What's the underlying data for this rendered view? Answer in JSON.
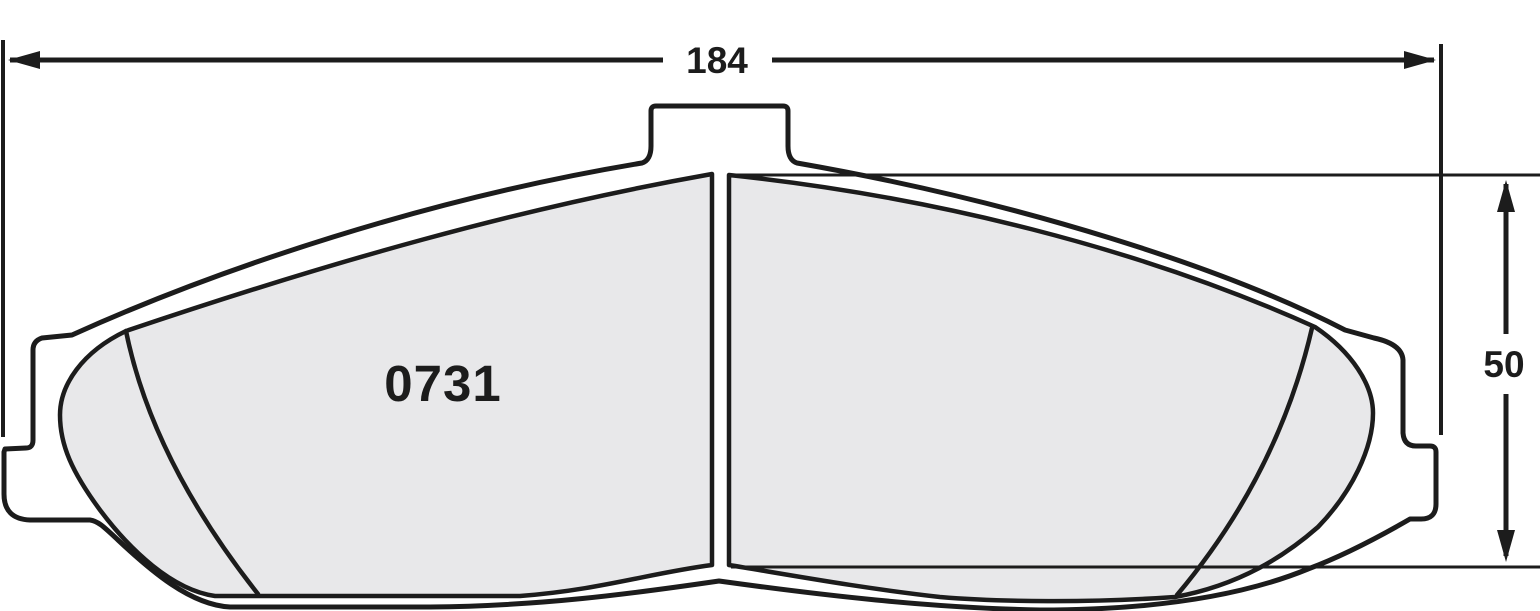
{
  "drawing": {
    "part_number": "0731",
    "width_dimension": {
      "value": "184"
    },
    "height_dimension": {
      "value": "50"
    },
    "colors": {
      "line": "#1c1c1c",
      "friction_fill": "#e8e8ea",
      "backplate_fill": "#ffffff",
      "background": "#ffffff"
    }
  }
}
